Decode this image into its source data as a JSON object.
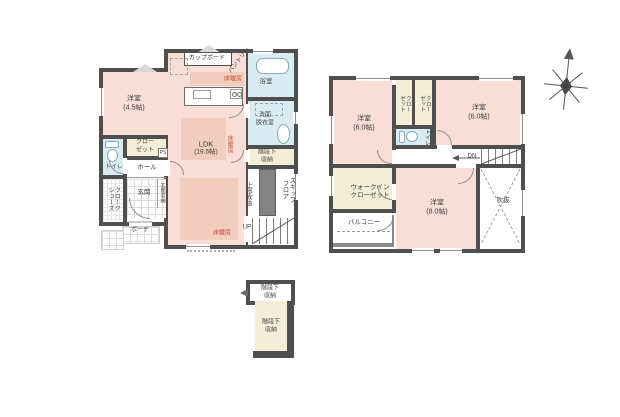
{
  "colors": {
    "wall": "#4f4f4f",
    "room_pink": "#f8ded7",
    "floor_heating_pink": "#f0cdbc",
    "closet_cream": "#f4edd8",
    "water_blue": "#d9ecf4",
    "heating_text_red": "#c84b3c"
  },
  "floor1": {
    "cupboard": "カップボード",
    "pantry": "パントリー",
    "floor_heating": "床暖房",
    "bath": "浴室",
    "washroom_line1": "洗面",
    "washroom_line2": "脱衣室",
    "bedroom_name": "洋室",
    "bedroom_size": "(4.5帖)",
    "closet_line1": "クロー",
    "closet_line2": "ゼット",
    "ps": "PS",
    "toilet": "トイレ",
    "hall": "ホール",
    "shoes_closet": "シューズクローク",
    "entrance": "玄関",
    "entrance_storage": "玄関収納",
    "porch": "ポーチ",
    "ldk_name": "LDK",
    "ldk_size": "(19.5帖)",
    "understair_line1": "階段下",
    "understair_line2": "収納",
    "skip_floor": "スキップフロア",
    "void_above": "上部吹抜",
    "up": "UP"
  },
  "floor2": {
    "bedroom_a_name": "洋室",
    "bedroom_a_size": "(6.0帖)",
    "bedroom_b_name": "洋室",
    "bedroom_b_size": "(6.0帖)",
    "bedroom_c_name": "洋室",
    "bedroom_c_size": "(8.0帖)",
    "closet": "クローゼット",
    "toilet": "トイレ",
    "down": "DN",
    "wic_line1": "ウォークイン",
    "wic_line2": "クローゼット",
    "balcony": "バルコニー",
    "void": "吹抜"
  },
  "annex": {
    "understair_line1": "階段下",
    "understair_line2": "収納"
  }
}
